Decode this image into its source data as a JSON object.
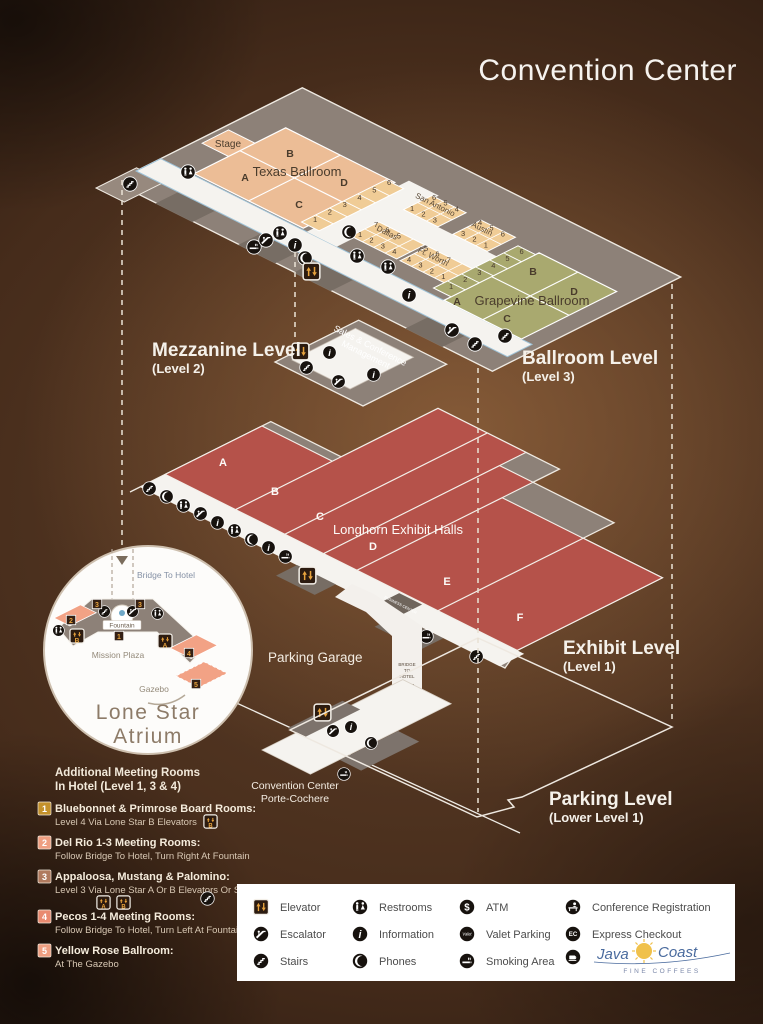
{
  "title": "Convention Center",
  "levels": {
    "ballroom": {
      "label": "Ballroom Level",
      "sublabel": "(Level 3)",
      "texas": {
        "name": "Texas Ballroom",
        "stage": "Stage",
        "sections": {
          "a": "A",
          "b": "B",
          "c": "C",
          "d": "D"
        },
        "side_rooms": "123456"
      },
      "san_antonio": {
        "name": "San Antonio",
        "row1": "123",
        "row2": "654"
      },
      "dallas": {
        "name": "Dallas",
        "row1": "1234",
        "row2": "765"
      },
      "austin": {
        "name": "Austin",
        "row1": "321",
        "row2": "456"
      },
      "ft_worth": {
        "name": "Ft. Worth",
        "row1": "4321",
        "row2": "567"
      },
      "grapevine": {
        "name": "Grapevine Ballroom",
        "sections": {
          "a": "A",
          "b": "B",
          "c": "C",
          "d": "D"
        },
        "side_rooms": "123456"
      }
    },
    "mezzanine": {
      "label": "Mezzanine Level",
      "sublabel": "(Level 2)",
      "office1": "Sales & Conference",
      "office2": "Management"
    },
    "exhibit": {
      "label": "Exhibit Level",
      "sublabel": "(Level 1)",
      "halls_name": "Longhorn Exhibit Halls",
      "halls": {
        "a": "A",
        "b": "B",
        "c": "C",
        "d": "D",
        "e": "E",
        "f": "F"
      },
      "business_center": "BUSINESS CENTER",
      "road_sign1": "BRIDGE",
      "road_sign2": "TO",
      "road_sign3": "HOTEL"
    },
    "parking": {
      "label": "Parking Level",
      "sublabel": "(Lower Level 1)",
      "garage": "Parking Garage",
      "porte1": "Convention Center",
      "porte2": "Porte-Cochere"
    }
  },
  "atrium": {
    "title1": "Lone Star",
    "title2": "Atrium",
    "bridge": "Bridge To Hotel",
    "fountain": "Fountain",
    "plaza": "Mission Plaza",
    "gazebo": "Gazebo",
    "markers": {
      "m1": "1",
      "m2": "2",
      "m3a": "3",
      "m3b": "3",
      "m4": "4",
      "m5": "5"
    },
    "elev_a": "A",
    "elev_b": "B"
  },
  "hotel_rooms": {
    "heading1": "Additional Meeting Rooms",
    "heading2": "In Hotel (Level 1, 3 & 4)",
    "items": [
      {
        "num": "1",
        "title": "Bluebonnet & Primrose Board Rooms:",
        "desc": "Level 4 Via Lone Star B Elevators"
      },
      {
        "num": "2",
        "title": "Del Rio 1-3 Meeting Rooms:",
        "desc": "Follow Bridge To Hotel, Turn Right At Fountain"
      },
      {
        "num": "3",
        "title": "Appaloosa, Mustang & Palomino:",
        "desc": "Level 3 Via Lone Star A Or B Elevators Or Stairs"
      },
      {
        "num": "4",
        "title": "Pecos 1-4 Meeting Rooms:",
        "desc": "Follow Bridge To Hotel, Turn Left At Fountain"
      },
      {
        "num": "5",
        "title": "Yellow Rose Ballroom:",
        "desc": "At The Gazebo"
      }
    ],
    "elev_a": "A",
    "elev_b": "B"
  },
  "legend": {
    "elevator": "Elevator",
    "escalator": "Escalator",
    "stairs": "Stairs",
    "restrooms": "Restrooms",
    "information": "Information",
    "phones": "Phones",
    "atm": "ATM",
    "valet": "Valet Parking",
    "smoking": "Smoking Area",
    "conference": "Conference Registration",
    "express": "Express Checkout",
    "brand1": "Java",
    "brand2": "Coast",
    "brand_sub": "FINE COFFEES"
  },
  "colors": {
    "accent_gold": "#e8a33d",
    "hall_red": "#b5524a",
    "ballroom_peach": "#ecbd96",
    "meeting_tan": "#f0cc96",
    "grapevine_olive": "#a9a96f",
    "atrium_salmon": "#f2a285",
    "deck_gray": "#8d8178",
    "walk_white": "#f5f3ef"
  }
}
